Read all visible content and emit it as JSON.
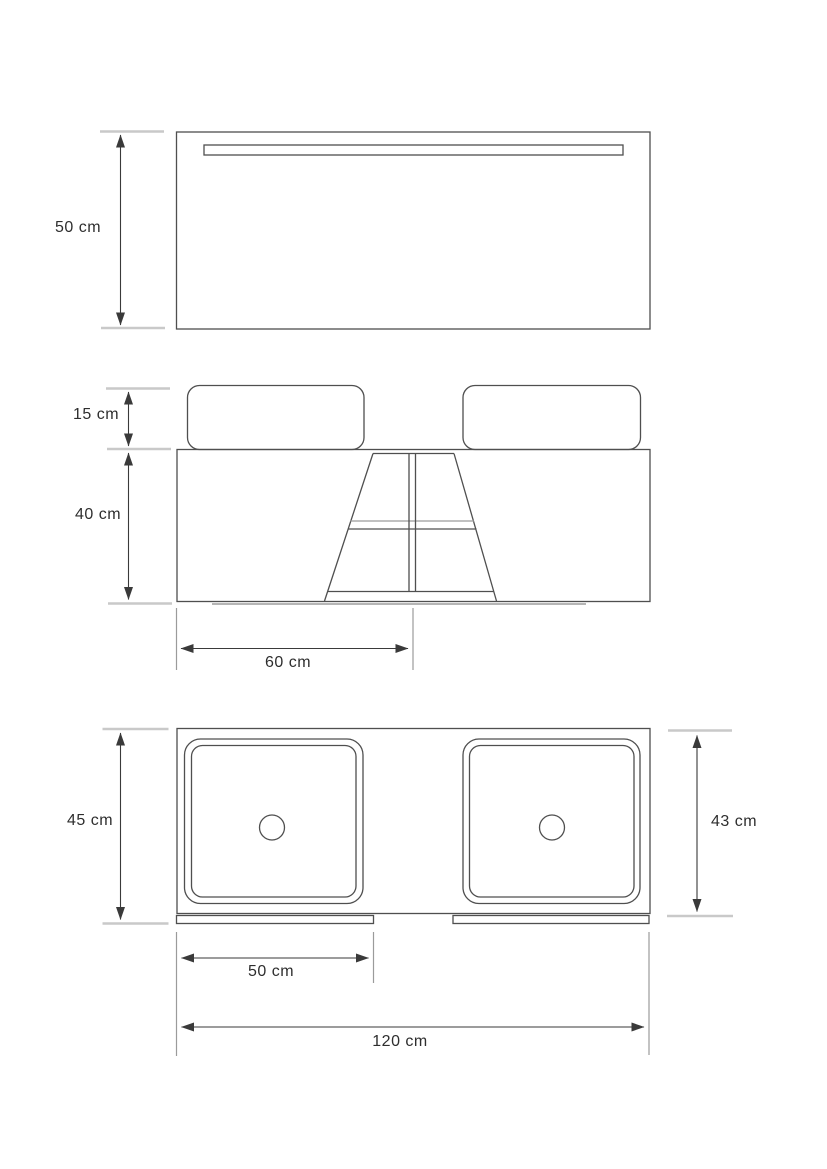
{
  "colors": {
    "background": "#ffffff",
    "line": "#4f4f4f",
    "light_line": "#9b9b9b",
    "tick": "#c9c9c9",
    "shadow": "#b5b5b5",
    "arrow": "#3a3a3a",
    "text": "#2e2e2e"
  },
  "views": {
    "mirror_front": {
      "dims": {
        "height": {
          "label": "50 cm",
          "value_cm": 50
        }
      }
    },
    "vanity_front": {
      "dims": {
        "basin_height": {
          "label": "15 cm",
          "value_cm": 15
        },
        "cabinet_height": {
          "label": "40 cm",
          "value_cm": 40
        },
        "open_section_width": {
          "label": "60 cm",
          "value_cm": 60
        }
      }
    },
    "vanity_top": {
      "dims": {
        "overall_depth": {
          "label": "45 cm",
          "value_cm": 45
        },
        "basin_depth": {
          "label": "43 cm",
          "value_cm": 43
        },
        "basin_width": {
          "label": "50 cm",
          "value_cm": 50
        },
        "overall_width": {
          "label": "120 cm",
          "value_cm": 120
        }
      }
    }
  }
}
